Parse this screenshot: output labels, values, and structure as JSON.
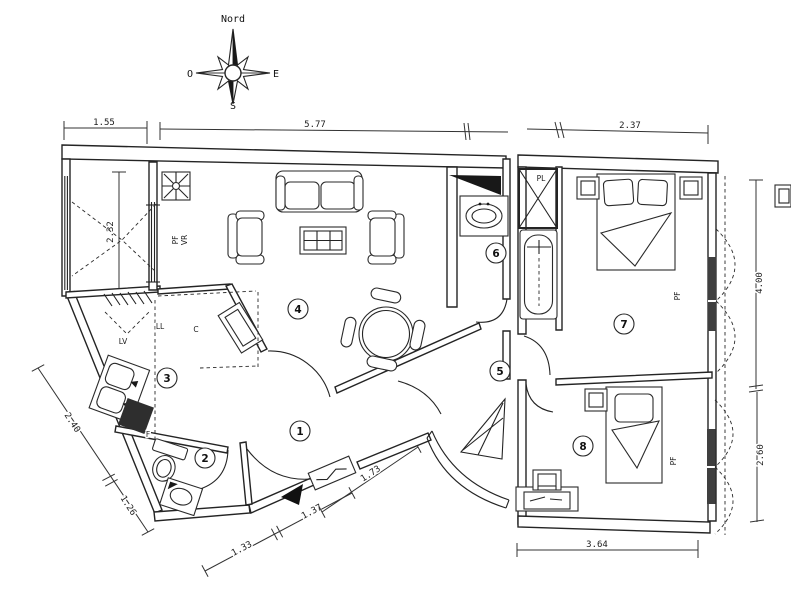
{
  "canvas": {
    "width": 791,
    "height": 600,
    "background": "#ffffff",
    "ink": "#242424"
  },
  "compass": {
    "north": "Nord",
    "west": "O",
    "east": "E",
    "south": "S"
  },
  "dims": {
    "top_left": "1.55",
    "top_center": "5.77",
    "top_right": "2.37",
    "loggia_depth": "2.32",
    "kitchen_wall_a": "2.40",
    "kitchen_wall_b": "1.26",
    "entry_a": "1.33",
    "entry_b": "1.37",
    "entry_c": "1.73",
    "bedroom7_height": "4.00",
    "bedroom8_height": "2.60",
    "bottom_width": "3.64"
  },
  "rooms": [
    {
      "number": "1"
    },
    {
      "number": "2"
    },
    {
      "number": "3"
    },
    {
      "number": "4"
    },
    {
      "number": "5"
    },
    {
      "number": "6"
    },
    {
      "number": "7"
    },
    {
      "number": "8"
    }
  ],
  "labels": {
    "window_pf": "PF",
    "window_vr": "VR",
    "dishwasher": "LV",
    "washing_machine": "LL",
    "cooker": "C",
    "fridge": "F",
    "closet": "PL",
    "bedroom7_window": "PF",
    "bedroom8_window": "PF"
  }
}
